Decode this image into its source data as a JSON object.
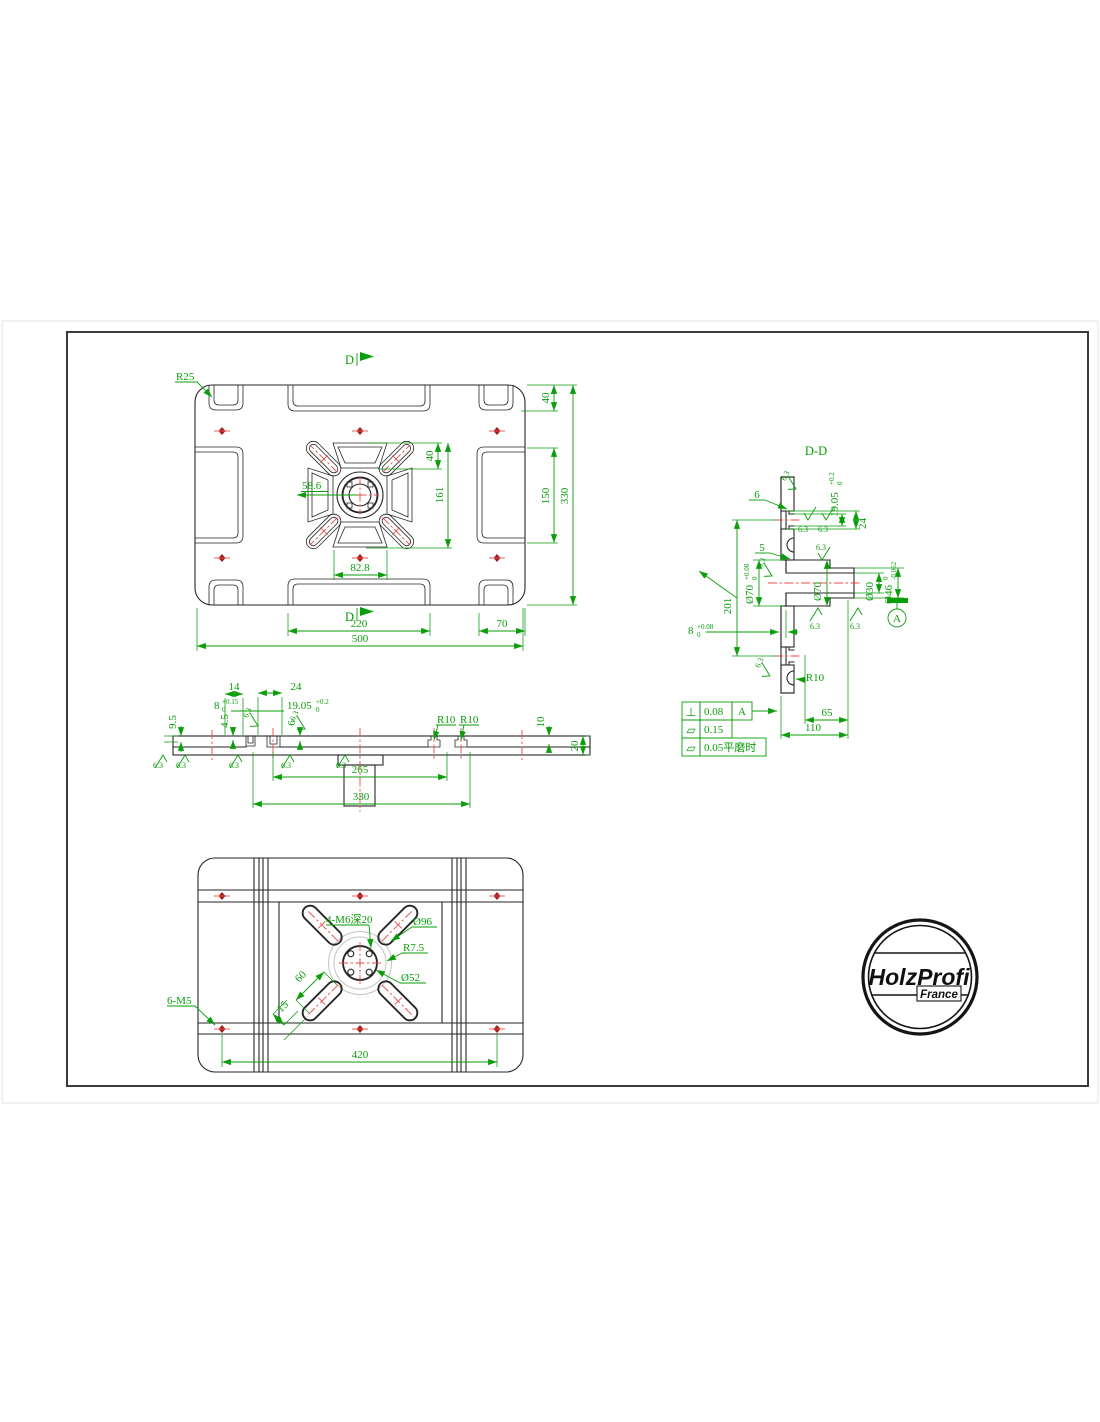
{
  "top_view": {
    "r25": "R25",
    "d_top": "D",
    "d_bottom": "D",
    "dim_58_6": "58.6",
    "dim_82_8": "82.8",
    "dim_40_inner": "40",
    "dim_161": "161",
    "dim_40_right": "40",
    "dim_150": "150",
    "dim_330": "330",
    "dim_220": "220",
    "dim_70": "70",
    "dim_500": "500"
  },
  "section_view": {
    "title": "D-D",
    "dim_6": "6",
    "dim_5": "5",
    "slot_nom": "19.05",
    "slot_up": "+0.2",
    "slot_low": "0",
    "dim_24": "24",
    "dim_201": "201",
    "cbore_nom": "Ø70",
    "cbore_up": "+0.08",
    "cbore_low": "0",
    "hub_od": "Ø70",
    "bore": "Ø30",
    "spigot_nom": "Ø46",
    "spigot_up": "0",
    "spigot_low": "-0.062",
    "depth_nom": "8",
    "depth_up": "+0.08",
    "depth_low": "0",
    "r10": "R10",
    "dim_65": "65",
    "dim_110": "110",
    "datum": "A",
    "finish": "6.3"
  },
  "side_view": {
    "dim_14": "14",
    "dim_24": "24",
    "w8_nom": "8",
    "w8_up": "+0.15",
    "w8_low": "0",
    "slot_nom": "19.05",
    "slot_up": "+0.2",
    "slot_low": "0",
    "dim_9_5": "9.5",
    "dim_4_5": "4.5",
    "dim_6": "6",
    "r10_a": "R10",
    "r10_b": "R10",
    "dim_10": "10",
    "dim_20": "20",
    "dim_265": "265",
    "dim_330": "330",
    "finish": "6.3"
  },
  "bottom_view": {
    "thread_m6": "4-M6深20",
    "dia96": "Ø96",
    "r75": "R7.5",
    "dia52": "Ø52",
    "dim_60": "60",
    "dim_15": "15",
    "thread_m5": "6-M5",
    "dim_420": "420"
  },
  "tol_table": {
    "rows": [
      {
        "sym": "⊥",
        "val": "0.08",
        "ref": "A"
      },
      {
        "sym": "▱",
        "val": "0.15",
        "ref": ""
      },
      {
        "sym": "▱",
        "val": "0.05平磨时",
        "ref": ""
      }
    ]
  },
  "logo": {
    "brand": "HolzProfi",
    "country": "France"
  }
}
